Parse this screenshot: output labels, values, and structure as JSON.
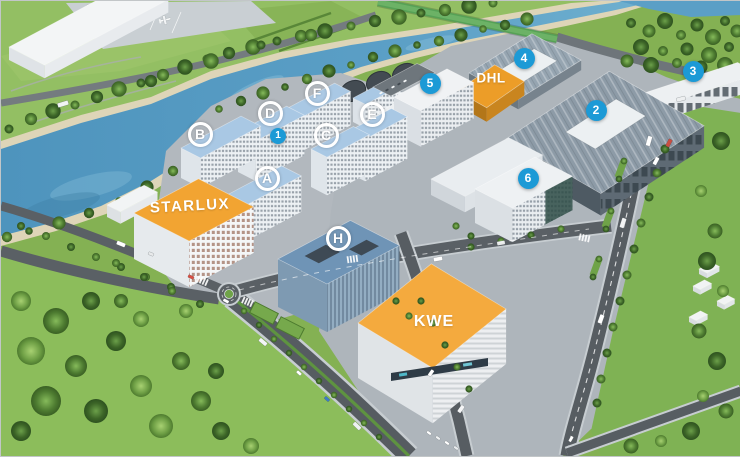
{
  "scene": {
    "type": "3D aerial site rendering",
    "description": "Riverside logistics and industrial park with lettered residential blocks and numbered warehouse facilities"
  },
  "building_labels": [
    {
      "id": "starlux",
      "text": "STARLUX"
    },
    {
      "id": "dhl",
      "text": "DHL"
    },
    {
      "id": "kwe",
      "text": "KWE"
    }
  ],
  "badges": {
    "letters": [
      {
        "id": "A",
        "label": "A"
      },
      {
        "id": "B",
        "label": "B"
      },
      {
        "id": "C",
        "label": "C"
      },
      {
        "id": "D",
        "label": "D"
      },
      {
        "id": "E",
        "label": "E"
      },
      {
        "id": "F",
        "label": "F"
      },
      {
        "id": "H",
        "label": "H"
      }
    ],
    "numbers": [
      {
        "id": "1",
        "label": "1"
      },
      {
        "id": "2",
        "label": "2"
      },
      {
        "id": "3",
        "label": "3"
      },
      {
        "id": "4",
        "label": "4"
      },
      {
        "id": "5",
        "label": "5"
      },
      {
        "id": "6",
        "label": "6"
      }
    ]
  },
  "colors": {
    "badge_blue": "#1C9AD6",
    "badge_text": "#FFFFFF",
    "letter_badge_ring": "#FFFFFF",
    "roof_orange": "#F2A432",
    "roof_light_blue": "#A9C8E4",
    "roof_gray": "#8D9BA7",
    "water_blue": "#4E94BD",
    "grass_green": "#84B153",
    "road_gray": "#565C61"
  }
}
